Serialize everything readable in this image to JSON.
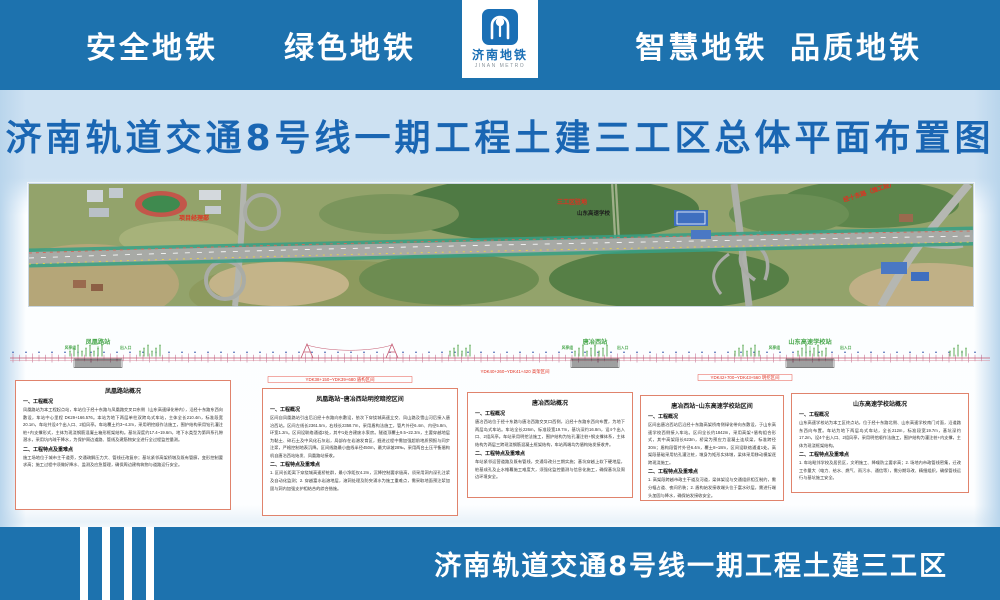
{
  "header": {
    "left_slogan": "安全地铁　　绿色地铁",
    "right_slogan": "智慧地铁  品质地铁",
    "logo_cn": "济南地铁",
    "logo_en": "JINAN METRO"
  },
  "title": "济南轨道交通8号线一期工程土建三工区总体平面布置图",
  "footer_label": "济南轨道交通8号线一期工程土建三工区",
  "colors": {
    "band_blue": "#1d72ae",
    "title_blue": "#1a66b3",
    "station_green": "#4aa84e",
    "chainage_red": "#e03020",
    "box_border": "#e0836c"
  },
  "map_labels": {
    "camp": "项目经理部",
    "site": "三工区驻地",
    "school": "山东高速学校",
    "road": "经十东路（施工段）"
  },
  "diagram": {
    "stations": [
      {
        "name": "凤凰路站",
        "note_left": "风亭组",
        "note_right": "出入口"
      },
      {
        "name": "唐冶西站",
        "note_left": "风亭组",
        "note_right": "出入口"
      },
      {
        "name": "山东高速学校站",
        "note_left": "风亭组",
        "note_right": "出入口"
      }
    ],
    "seg_labels": [
      "YDK38+150~YDK39+680 盾构区间",
      "YDK40+260~YDK41+420 高架区间",
      "YDK42+700~YDK43+560 明挖区间"
    ]
  },
  "boxes": [
    {
      "title": "凤凰路站概况",
      "h1": "一、工程概况",
      "p1": "凤凰路站为本工程起点站，车站位于经十东路与凤凰路交叉口东侧（山东高速绿化带内），沿经十东路东西向敷设，车站中心里程 DK29+166.576。本站为地下两层单柱双跨岛式车站，主体全长210.4m，标准段宽20.1m，车站共设4个出入口、2组风亭。车站覆土约3~4.2m，采用明挖顺作法施工，围护结构采用钻孔灌注桩+内支撑形式，主体为现浇钢筋混凝土箱形框架结构。基坑深度约17.4~19.6m，地下水类型为第四系孔隙潜水，采用坑内疏干降水，为保护周边道路、管线及建筋物安全进行全过程监控量测。",
      "h2": "二、工程特点及重难点",
      "p2": "施工场地位于城市主干道旁，交通疏解压力大、管线迁改复杂；基坑紧邻高架桥墩及既有管廊，变形控制要求高；施工过程中须做好降水、监测及应急管理，确保周边建构筑物与道路运行安全。"
    },
    {
      "title": "凤凰路站~唐冶西站明挖暗挖区间",
      "h1": "一、工程概况",
      "p1": "区间自凤凰路站引出后沿经十东路向东敷设，依次下穿绕城高速立交、凤山路及雪山河后接入唐冶西站。区间左线长2361.5m，右线长2358.7m，采用盾构法施工，管片外径6.4m、内径5.8m、环宽1.2m。区间设联络通道2处，其中1处合建废水泵房。隧道顶覆土9.5~22.3m，主要穿越地层为黏土、碎石土及中风化石灰岩，局部存在岩溶发育区，掘进过程中需加强超前地质预报与同步注浆，严格控制地表沉降。区间线路最小曲线半径450m，最大纵坡28‰，采用两台土压平衡盾构机自唐冶西站始发、凤凰路站接收。",
      "h2": "二、工程特点及重难点",
      "p2": "1. 区间长距离下穿绕城高速桥桩群，最小净距仅4.2m，沉降控制要求极高，须采用洞内深孔注浆及自动化监测；2. 穿越富水岩溶地层，溶洞处理及防突涌水为施工重难点，需采取地面预注浆加固与洞内加强支护相结合的综合措施。"
    },
    {
      "title": "唐冶西站概况",
      "h1": "一、工程概况",
      "p1": "唐冶西站位于经十东路与唐冶西路交叉口西侧，沿经十东路东西向布置，为地下两层岛式车站。车站全长226m，标准段宽19.7m，基坑深约16.8m，设4个出入口、2组风亭。车站采用明挖法施工，围护结构为钻孔灌注桩+钢支撑体系，主体结构为两层三跨现浇钢筋混凝土框架结构，车站两端均为盾构始发接收井。",
      "h2": "二、工程特点及重难点",
      "p2": "车站紧邻运营道路及既有管线，交通导改分三期实施；基坑穿越上软下硬地层，桩基成孔及止水帷幕施工难度大，须强化监控量测与信息化施工，确保基坑及周边环境安全。"
    },
    {
      "title": "唐冶西站~山东高速学校站区间",
      "h1": "一、工程概况",
      "p1": "区间出唐冶西站后沿经十东路高架桥南侧绿化带向东敷设，于山东高速学校西侧接入车站。区间全长约1842m，采用高架+盾构组合形式，其中高架段长623m，桥梁为预应力混凝土连续梁，标准跨径30m；盾构段管片外径6.4m，覆土8~18m，区间设联络通道1处。高架段基础采用钻孔灌注桩，墩身为矩形实体墩，梁体采用移动模架逐跨现浇施工。",
      "h2": "二、工程特点及重难点",
      "p2": "1. 高架段跨越市政主干道及河道，梁体架设与交通组织相互制约，需分幅占道、夜间吊装；2. 盾构始发接收端头位于富水砂层，需进行端头加固与降水，确保始发接收安全。"
    },
    {
      "title": "山东高速学校站概况",
      "h1": "一、工程概况",
      "p1": "山东高速学校站为本工区终点站，位于经十东路北侧、山东高速学校南门对面，沿道路东西向布置。车站为地下两层岛式车站，全长212m，标准段宽19.7m，基坑深约17.2m，设4个出入口、2组风亭，采用明挖顺作法施工，围护结构为灌注桩+内支撑，主体为现浇框架结构。",
      "h2": "二、工程特点及重难点",
      "p2": "1. 车站毗邻学校及居民区，文明施工、降噪防尘要求高；2. 场地内市政管线密集，迁改工作量大（电力、给水、燃气、雨污水、通信等），需分期导改、精细组织，确保管线运行与基坑施工安全。"
    }
  ]
}
